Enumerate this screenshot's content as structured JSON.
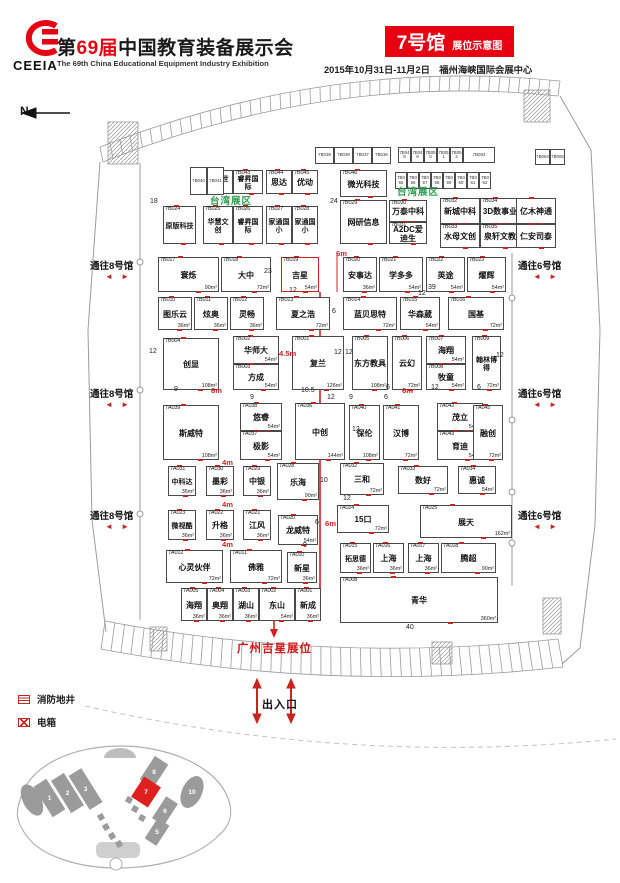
{
  "header": {
    "logo": "CEEIA",
    "t1": "第",
    "t2": "69",
    "t3": "届",
    "t4": "中国教育装备展示会",
    "subtitle": "The 69th China Educational Equipment Industry Exhibition",
    "badge": "7号馆",
    "badge_sub": "展位示意图",
    "date_venue": "2015年10月31日-11月2日　福州海峡国际会展中心"
  },
  "compass": "N",
  "zone_labels": [
    {
      "text": "台湾展区",
      "x": 210,
      "y": 193
    },
    {
      "text": "台湾展区",
      "x": 397,
      "y": 184
    }
  ],
  "corridors": [
    {
      "side": "left",
      "text": "通往8号馆",
      "x": 90,
      "y": 258
    },
    {
      "side": "left",
      "text": "通往8号馆",
      "x": 90,
      "y": 386
    },
    {
      "side": "left",
      "text": "通往8号馆",
      "x": 90,
      "y": 508
    },
    {
      "side": "right",
      "text": "通往6号馆",
      "x": 518,
      "y": 258
    },
    {
      "side": "right",
      "text": "通往6号馆",
      "x": 518,
      "y": 386
    },
    {
      "side": "right",
      "text": "通往6号馆",
      "x": 518,
      "y": 508
    }
  ],
  "booths": [
    {
      "x": 203,
      "y": 170,
      "w": 30,
      "h": 24,
      "id": "7B042",
      "name": "鸿贝世界"
    },
    {
      "x": 233,
      "y": 170,
      "w": 30,
      "h": 24,
      "id": "7B043",
      "name": "睿昇国际"
    },
    {
      "x": 266,
      "y": 170,
      "w": 26,
      "h": 24,
      "id": "7B044",
      "name": "思达"
    },
    {
      "x": 292,
      "y": 170,
      "w": 26,
      "h": 24,
      "id": "7B045",
      "name": "优动"
    },
    {
      "x": 340,
      "y": 170,
      "w": 47,
      "h": 27,
      "id": "7B046",
      "name": "微光科技"
    },
    {
      "x": 163,
      "y": 206,
      "w": 33,
      "h": 38,
      "id": "7B024",
      "name": "原版科技"
    },
    {
      "x": 203,
      "y": 206,
      "w": 30,
      "h": 38,
      "id": "7B025",
      "name": "华慧文创"
    },
    {
      "x": 233,
      "y": 206,
      "w": 30,
      "h": 38,
      "id": "7B026",
      "name": "睿昇国际"
    },
    {
      "x": 266,
      "y": 206,
      "w": 26,
      "h": 38,
      "id": "7B027",
      "name": "家通国小"
    },
    {
      "x": 292,
      "y": 206,
      "w": 26,
      "h": 38,
      "id": "7B028",
      "name": "家通国小"
    },
    {
      "x": 340,
      "y": 200,
      "w": 47,
      "h": 44,
      "id": "7B029",
      "name": "网研信息"
    },
    {
      "x": 389,
      "y": 200,
      "w": 38,
      "h": 22,
      "id": "7B030",
      "name": "万泰中科"
    },
    {
      "x": 389,
      "y": 222,
      "w": 38,
      "h": 22,
      "id": "7B031",
      "name": "A2DC爱迪生"
    },
    {
      "x": 440,
      "y": 198,
      "w": 40,
      "h": 26,
      "id": "7B032",
      "name": "新城中科"
    },
    {
      "x": 480,
      "y": 198,
      "w": 40,
      "h": 26,
      "id": "7B034",
      "name": "3D数事业"
    },
    {
      "x": 440,
      "y": 224,
      "w": 40,
      "h": 24,
      "id": "7B033",
      "name": "水母文创"
    },
    {
      "x": 480,
      "y": 224,
      "w": 40,
      "h": 24,
      "id": "7B035",
      "name": "泉轩文教"
    },
    {
      "x": 516,
      "y": 198,
      "w": 40,
      "h": 26,
      "id": "",
      "name": "亿木神通"
    },
    {
      "x": 516,
      "y": 224,
      "w": 40,
      "h": 24,
      "id": "",
      "name": "仁安司泰"
    },
    {
      "x": 158,
      "y": 257,
      "w": 61,
      "h": 35,
      "id": "7B017",
      "name": "寰烁",
      "area": "90m²"
    },
    {
      "x": 221,
      "y": 257,
      "w": 50,
      "h": 35,
      "id": "7B018",
      "name": "大中",
      "area": "72m²"
    },
    {
      "x": 281,
      "y": 257,
      "w": 38,
      "h": 35,
      "id": "7B019",
      "name": "吉星",
      "area": "54m²",
      "hl": true
    },
    {
      "x": 343,
      "y": 257,
      "w": 34,
      "h": 35,
      "id": "7B020",
      "name": "安事达",
      "area": "36m²"
    },
    {
      "x": 379,
      "y": 257,
      "w": 44,
      "h": 35,
      "id": "7B021",
      "name": "学多多",
      "area": "54m²"
    },
    {
      "x": 426,
      "y": 257,
      "w": 39,
      "h": 35,
      "id": "7B022",
      "name": "英途",
      "area": "54m²"
    },
    {
      "x": 467,
      "y": 257,
      "w": 39,
      "h": 35,
      "id": "7B023",
      "name": "燿辉",
      "area": "54m²"
    },
    {
      "x": 158,
      "y": 297,
      "w": 34,
      "h": 33,
      "id": "7B010",
      "name": "图乐云",
      "area": "36m²"
    },
    {
      "x": 194,
      "y": 297,
      "w": 34,
      "h": 33,
      "id": "7B011",
      "name": "炫奥",
      "area": "36m²"
    },
    {
      "x": 230,
      "y": 297,
      "w": 34,
      "h": 33,
      "id": "7B012",
      "name": "灵畅",
      "area": "36m²"
    },
    {
      "x": 276,
      "y": 297,
      "w": 54,
      "h": 33,
      "id": "7B013",
      "name": "夏之浩",
      "area": "72m²"
    },
    {
      "x": 343,
      "y": 297,
      "w": 54,
      "h": 33,
      "id": "7B014",
      "name": "蓝贝思特",
      "area": "72m²"
    },
    {
      "x": 400,
      "y": 297,
      "w": 40,
      "h": 33,
      "id": "7B015",
      "name": "华森葳",
      "area": "54m²"
    },
    {
      "x": 448,
      "y": 297,
      "w": 56,
      "h": 33,
      "id": "7B016",
      "name": "国基",
      "area": "72m²"
    },
    {
      "x": 163,
      "y": 338,
      "w": 56,
      "h": 52,
      "id": "7B004",
      "name": "创显",
      "area": "108m²"
    },
    {
      "x": 233,
      "y": 336,
      "w": 46,
      "h": 28,
      "id": "7B002",
      "name": "华师大",
      "area": "54m²"
    },
    {
      "x": 233,
      "y": 364,
      "w": 46,
      "h": 26,
      "id": "7B003",
      "name": "方成",
      "area": "54m²"
    },
    {
      "x": 292,
      "y": 336,
      "w": 52,
      "h": 54,
      "id": "7B001",
      "name": "复兰",
      "area": "126m²"
    },
    {
      "x": 352,
      "y": 336,
      "w": 36,
      "h": 54,
      "id": "7B005",
      "name": "东方教具",
      "area": "108m²"
    },
    {
      "x": 392,
      "y": 336,
      "w": 30,
      "h": 54,
      "id": "7B006",
      "name": "云幻",
      "area": "72m²"
    },
    {
      "x": 426,
      "y": 336,
      "w": 40,
      "h": 28,
      "id": "7B007",
      "name": "海翔",
      "area": "54m²"
    },
    {
      "x": 426,
      "y": 364,
      "w": 40,
      "h": 26,
      "id": "7B008",
      "name": "牧童",
      "area": "54m²"
    },
    {
      "x": 472,
      "y": 336,
      "w": 29,
      "h": 54,
      "id": "7B009",
      "name": "翰林博得",
      "area": "72m²"
    },
    {
      "x": 163,
      "y": 405,
      "w": 56,
      "h": 55,
      "id": "7A039",
      "name": "斯威特",
      "area": "108m²"
    },
    {
      "x": 240,
      "y": 403,
      "w": 42,
      "h": 28,
      "id": "7A038",
      "name": "悠睿",
      "area": "54m²"
    },
    {
      "x": 240,
      "y": 431,
      "w": 42,
      "h": 29,
      "id": "7A037",
      "name": "极影",
      "area": "54m²"
    },
    {
      "x": 295,
      "y": 403,
      "w": 50,
      "h": 57,
      "id": "7A036",
      "name": "中创",
      "area": "144m²"
    },
    {
      "x": 349,
      "y": 405,
      "w": 31,
      "h": 55,
      "id": "7A040",
      "name": "保伦",
      "area": "108m²"
    },
    {
      "x": 383,
      "y": 405,
      "w": 36,
      "h": 55,
      "id": "7A041",
      "name": "汉博",
      "area": "72m²"
    },
    {
      "x": 437,
      "y": 403,
      "w": 46,
      "h": 28,
      "id": "7A042",
      "name": "茂立",
      "area": "54m²"
    },
    {
      "x": 437,
      "y": 431,
      "w": 46,
      "h": 29,
      "id": "7A043",
      "name": "育迪",
      "area": "54m²"
    },
    {
      "x": 473,
      "y": 405,
      "w": 30,
      "h": 55,
      "id": "7A045",
      "name": "融创",
      "area": "72m²"
    },
    {
      "x": 168,
      "y": 466,
      "w": 28,
      "h": 30,
      "id": "7A031",
      "name": "中科达",
      "area": "36m²"
    },
    {
      "x": 206,
      "y": 466,
      "w": 28,
      "h": 30,
      "id": "7A030",
      "name": "墨彩",
      "area": "36m²"
    },
    {
      "x": 243,
      "y": 466,
      "w": 28,
      "h": 30,
      "id": "7A029",
      "name": "中银",
      "area": "36m²"
    },
    {
      "x": 277,
      "y": 463,
      "w": 42,
      "h": 37,
      "id": "7A028",
      "name": "乐海",
      "area": "90m²"
    },
    {
      "x": 340,
      "y": 463,
      "w": 44,
      "h": 32,
      "id": "7A032",
      "name": "三和",
      "area": "72m²"
    },
    {
      "x": 398,
      "y": 466,
      "w": 50,
      "h": 28,
      "id": "7A033",
      "name": "数好",
      "area": "72m²"
    },
    {
      "x": 458,
      "y": 466,
      "w": 38,
      "h": 28,
      "id": "7A034",
      "name": "惠诚",
      "area": "54m²"
    },
    {
      "x": 168,
      "y": 510,
      "w": 28,
      "h": 30,
      "id": "7A023",
      "name": "微视酷",
      "area": "36m²"
    },
    {
      "x": 206,
      "y": 510,
      "w": 28,
      "h": 30,
      "id": "7A022",
      "name": "升格",
      "area": "36m²"
    },
    {
      "x": 243,
      "y": 510,
      "w": 28,
      "h": 30,
      "id": "7A021",
      "name": "江风",
      "area": "36m²"
    },
    {
      "x": 278,
      "y": 515,
      "w": 40,
      "h": 30,
      "id": "7A020",
      "name": "龙威特",
      "area": "54m²"
    },
    {
      "x": 337,
      "y": 505,
      "w": 52,
      "h": 28,
      "id": "7A024",
      "name": "15口",
      "area": "72m²"
    },
    {
      "x": 420,
      "y": 505,
      "w": 92,
      "h": 33,
      "id": "7A025",
      "name": "展天",
      "area": "162m²"
    },
    {
      "x": 340,
      "y": 543,
      "w": 31,
      "h": 30,
      "id": "7A015",
      "name": "拓思德",
      "area": "36m²"
    },
    {
      "x": 373,
      "y": 543,
      "w": 31,
      "h": 30,
      "id": "7A016",
      "name": "上海",
      "area": "36m²"
    },
    {
      "x": 408,
      "y": 543,
      "w": 31,
      "h": 30,
      "id": "7A017",
      "name": "上海",
      "area": "36m²"
    },
    {
      "x": 441,
      "y": 543,
      "w": 55,
      "h": 30,
      "id": "7A018",
      "name": "腾超",
      "area": "90m²"
    },
    {
      "x": 166,
      "y": 550,
      "w": 57,
      "h": 33,
      "id": "7A012",
      "name": "心灵伙伴",
      "area": "72m²"
    },
    {
      "x": 230,
      "y": 550,
      "w": 52,
      "h": 33,
      "id": "7A011",
      "name": "佛雅",
      "area": "72m²"
    },
    {
      "x": 287,
      "y": 552,
      "w": 30,
      "h": 31,
      "id": "7A010",
      "name": "新星",
      "area": "36m²"
    },
    {
      "x": 181,
      "y": 588,
      "w": 26,
      "h": 33,
      "id": "7A005",
      "name": "海翔",
      "area": "36m²"
    },
    {
      "x": 207,
      "y": 588,
      "w": 26,
      "h": 33,
      "id": "7A004",
      "name": "奥翔",
      "area": "36m²"
    },
    {
      "x": 233,
      "y": 588,
      "w": 26,
      "h": 33,
      "id": "7A003",
      "name": "湖山",
      "area": "36m²"
    },
    {
      "x": 259,
      "y": 588,
      "w": 36,
      "h": 33,
      "id": "7A002",
      "name": "东山",
      "area": "54m²"
    },
    {
      "x": 295,
      "y": 588,
      "w": 26,
      "h": 33,
      "id": "7A001",
      "name": "新成",
      "area": "36m²"
    },
    {
      "x": 340,
      "y": 577,
      "w": 158,
      "h": 46,
      "id": "7A008",
      "name": "青华",
      "area": "360m²"
    }
  ],
  "mini_strips": [
    {
      "x": 315,
      "y": 147,
      "w": 19,
      "h": 17,
      "ids": [
        "7B039",
        "7B038",
        "7B037",
        "7B036"
      ]
    },
    {
      "x": 398,
      "y": 147,
      "w": 13,
      "h": 16,
      "ids": [
        "7B048",
        "7B049",
        "7B050",
        "7B051",
        "7B052"
      ]
    },
    {
      "x": 463,
      "y": 147,
      "w": 32,
      "h": 16,
      "ids": [
        "7B053"
      ]
    },
    {
      "x": 395,
      "y": 172,
      "w": 12,
      "h": 17,
      "ids": [
        "7B055",
        "7B056",
        "7B057",
        "7B058",
        "7B059",
        "7B060",
        "7B061",
        "7B062"
      ]
    },
    {
      "x": 190,
      "y": 167,
      "w": 17,
      "h": 28,
      "ids": [
        "7B040",
        "7B041"
      ]
    },
    {
      "x": 535,
      "y": 149,
      "w": 15,
      "h": 16,
      "ids": [
        "7B064",
        "7B065"
      ]
    }
  ],
  "dims": [
    {
      "x": 150,
      "y": 198,
      "t": "18"
    },
    {
      "x": 330,
      "y": 198,
      "t": "24"
    },
    {
      "x": 336,
      "y": 249,
      "t": "6m",
      "r": 1
    },
    {
      "x": 264,
      "y": 268,
      "t": "23"
    },
    {
      "x": 289,
      "y": 287,
      "t": "12"
    },
    {
      "x": 428,
      "y": 284,
      "t": "39"
    },
    {
      "x": 332,
      "y": 308,
      "t": "6"
    },
    {
      "x": 418,
      "y": 290,
      "t": "12"
    },
    {
      "x": 149,
      "y": 348,
      "t": "12"
    },
    {
      "x": 279,
      "y": 349,
      "t": "4.5m",
      "r": 1
    },
    {
      "x": 334,
      "y": 349,
      "t": "12"
    },
    {
      "x": 345,
      "y": 349,
      "t": "12"
    },
    {
      "x": 496,
      "y": 352,
      "t": "12"
    },
    {
      "x": 174,
      "y": 386,
      "t": "9"
    },
    {
      "x": 211,
      "y": 386,
      "t": "6m",
      "r": 1
    },
    {
      "x": 301,
      "y": 387,
      "t": "10.5"
    },
    {
      "x": 386,
      "y": 384,
      "t": "6"
    },
    {
      "x": 431,
      "y": 384,
      "t": "12"
    },
    {
      "x": 477,
      "y": 384,
      "t": "6"
    },
    {
      "x": 402,
      "y": 386,
      "t": "6m",
      "r": 1
    },
    {
      "x": 250,
      "y": 394,
      "t": "9"
    },
    {
      "x": 327,
      "y": 394,
      "t": "12"
    },
    {
      "x": 349,
      "y": 394,
      "t": "9"
    },
    {
      "x": 384,
      "y": 394,
      "t": "6"
    },
    {
      "x": 352,
      "y": 426,
      "t": "12"
    },
    {
      "x": 222,
      "y": 458,
      "t": "4m",
      "r": 1
    },
    {
      "x": 320,
      "y": 477,
      "t": "10"
    },
    {
      "x": 343,
      "y": 495,
      "t": "12"
    },
    {
      "x": 222,
      "y": 500,
      "t": "4m",
      "r": 1
    },
    {
      "x": 315,
      "y": 519,
      "t": "6"
    },
    {
      "x": 325,
      "y": 519,
      "t": "6m",
      "r": 1
    },
    {
      "x": 222,
      "y": 540,
      "t": "4m",
      "r": 1
    },
    {
      "x": 303,
      "y": 542,
      "t": "9"
    },
    {
      "x": 406,
      "y": 624,
      "t": "40"
    }
  ],
  "route": {
    "label": "广州吉星展位",
    "x": 237,
    "y": 640
  },
  "entrance": {
    "label": "出入口",
    "x": 262,
    "y": 696
  },
  "legend": [
    {
      "icon": "fire-hydrant-icon",
      "label": "消防地井"
    },
    {
      "icon": "electric-box-icon",
      "label": "电箱"
    }
  ],
  "overview": {
    "shapes": [
      {
        "t": "e",
        "x": 24,
        "y": 58,
        "w": 9,
        "h": 17,
        "r": -28,
        "l": ""
      },
      {
        "t": "r",
        "x": 34,
        "y": 38,
        "w": 15,
        "h": 36,
        "r": -32,
        "l": "1"
      },
      {
        "t": "r",
        "x": 52,
        "y": 32,
        "w": 15,
        "h": 38,
        "r": -32,
        "l": "2"
      },
      {
        "t": "r",
        "x": 70,
        "y": 27,
        "w": 15,
        "h": 40,
        "r": -32,
        "l": "3"
      },
      {
        "t": "r",
        "x": 90,
        "y": 72,
        "w": 6,
        "h": 6,
        "r": -30,
        "l": ""
      },
      {
        "t": "r",
        "x": 95,
        "y": 82,
        "w": 6,
        "h": 6,
        "r": -30,
        "l": ""
      },
      {
        "t": "r",
        "x": 101,
        "y": 91,
        "w": 6,
        "h": 6,
        "r": -30,
        "l": ""
      },
      {
        "t": "r",
        "x": 108,
        "y": 99,
        "w": 6,
        "h": 6,
        "r": -30,
        "l": ""
      },
      {
        "t": "r",
        "x": 118,
        "y": 55,
        "w": 6,
        "h": 6,
        "r": 30,
        "l": ""
      },
      {
        "t": "r",
        "x": 124,
        "y": 64,
        "w": 6,
        "h": 6,
        "r": 30,
        "l": ""
      },
      {
        "t": "r",
        "x": 131,
        "y": 73,
        "w": 6,
        "h": 6,
        "r": 30,
        "l": ""
      },
      {
        "t": "r",
        "x": 138,
        "y": 16,
        "w": 16,
        "h": 28,
        "r": 33,
        "l": "8"
      },
      {
        "t": "r",
        "x": 128,
        "y": 38,
        "w": 20,
        "h": 24,
        "r": 33,
        "l": "7",
        "hl": true
      },
      {
        "t": "r",
        "x": 150,
        "y": 56,
        "w": 14,
        "h": 26,
        "r": 33,
        "l": "6"
      },
      {
        "t": "r",
        "x": 142,
        "y": 78,
        "w": 14,
        "h": 24,
        "r": 33,
        "l": "5"
      },
      {
        "t": "e",
        "x": 184,
        "y": 50,
        "w": 10,
        "h": 17,
        "r": 25,
        "l": "10"
      }
    ]
  },
  "colors": {
    "accent": "#e60012",
    "route": "#d42020",
    "zone_green": "#2f9e4f",
    "wall_gray": "#9a9a9a"
  }
}
